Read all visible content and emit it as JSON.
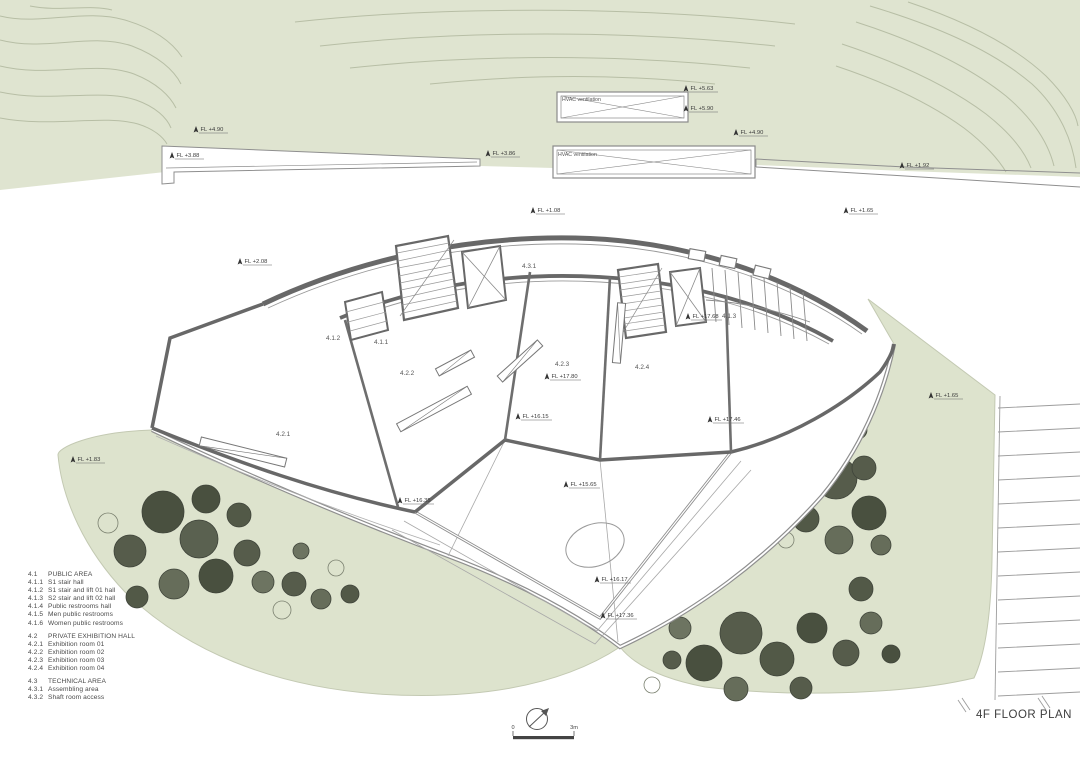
{
  "title": "4F FLOOR PLAN",
  "hvac": {
    "unit1_label": "HVAC ventilation",
    "unit2_label": "HVAC ventilation"
  },
  "scale_bar": {
    "start": "0",
    "end": "3m"
  },
  "rooms": {
    "r411": "4.1.1",
    "r412": "4.1.2",
    "r413": "4.1.3",
    "r421": "4.2.1",
    "r422": "4.2.2",
    "r423": "4.2.3",
    "r424": "4.2.4",
    "r431": "4.3.1"
  },
  "fl": {
    "fl1": "FL +4.90",
    "fl2": "FL +3.88",
    "fl3": "FL +3.86",
    "fl4": "FL +5.63",
    "fl5": "FL +5.90",
    "fl6": "FL +4.90",
    "fl7": "FL +1.92",
    "fl8": "FL +1.08",
    "fl9": "FL +1.65",
    "fl10": "FL +2.08",
    "fl11": "FL +1.65",
    "fl12": "FL +1.83",
    "fl13": "FL +17.68",
    "fl14": "FL +17.80",
    "fl15": "FL +16.15",
    "fl16": "FL +16.35",
    "fl17": "FL +15.65",
    "fl18": "FL +16.17",
    "fl19": "FL +17.36",
    "fl20": "FL +17.46"
  },
  "legend": {
    "sections": [
      {
        "code": "4.1",
        "title": "PUBLIC AREA",
        "items": [
          {
            "code": "4.1.1",
            "label": "S1 stair hall"
          },
          {
            "code": "4.1.2",
            "label": "S1 stair and lift 01 hall"
          },
          {
            "code": "4.1.3",
            "label": "S2 stair and lift 02 hall"
          },
          {
            "code": "4.1.4",
            "label": "Public restrooms hall"
          },
          {
            "code": "4.1.5",
            "label": "Men public restrooms"
          },
          {
            "code": "4.1.6",
            "label": "Women public restrooms"
          }
        ]
      },
      {
        "code": "4.2",
        "title": "PRIVATE EXHIBITION HALL",
        "items": [
          {
            "code": "4.2.1",
            "label": "Exhibition room 01"
          },
          {
            "code": "4.2.2",
            "label": "Exhibition room 02"
          },
          {
            "code": "4.2.3",
            "label": "Exhibition room 03"
          },
          {
            "code": "4.2.4",
            "label": "Exhibition room 04"
          }
        ]
      },
      {
        "code": "4.3",
        "title": "TECHNICAL AREA",
        "items": [
          {
            "code": "4.3.1",
            "label": "Assembling area"
          },
          {
            "code": "4.3.2",
            "label": "Shaft room access"
          }
        ]
      }
    ]
  },
  "colors": {
    "terrain": "#dfe4d0",
    "contour": "#b7bea5",
    "wall": "#686868",
    "tree_dark": "#49503f",
    "text": "#4a4a4a"
  }
}
